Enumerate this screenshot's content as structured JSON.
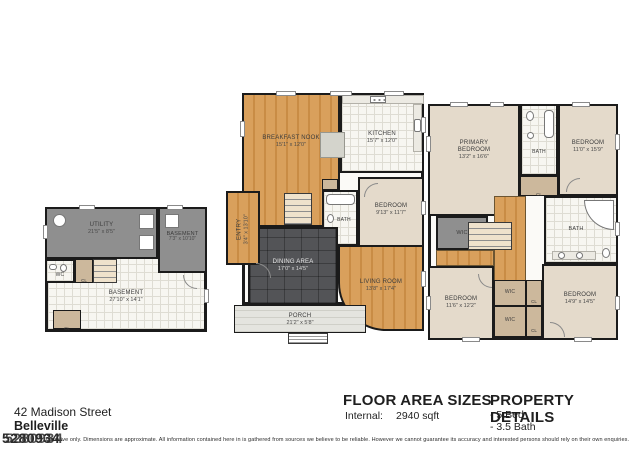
{
  "footer": {
    "address_line1": "42 Madison Street",
    "address_line2": "Belleville",
    "floor_area": {
      "title": "FLOOR AREA SIZES",
      "label": "Internal:",
      "value": "2940 sqft"
    },
    "property_details": {
      "title": "PROPERTY DETAILS",
      "items": [
        "- 5 Bed",
        "- 3.5 Bath"
      ]
    },
    "listing_id": "5280934",
    "disclaimer": "Indicative only. Dimensions are approximate. All information contained here in is gathered from sources we believe to be reliable. However we cannot guarantee its accuracy and interested persons should rely on their own enquiries."
  },
  "labels": {
    "cl": "CL",
    "wic": "WIC",
    "wc": "WC",
    "bath": "BATH"
  },
  "plans": {
    "basement": {
      "rooms": {
        "utility": {
          "name": "UTILITY",
          "dims": "21'5\" x 8'5\""
        },
        "basement_upper": {
          "name": "BASEMENT",
          "dims": "7'3\" x 10'10\""
        },
        "basement_main": {
          "name": "BASEMENT",
          "dims": "27'10\" x 14'1\""
        }
      }
    },
    "first_floor": {
      "rooms": {
        "breakfast_nook": {
          "name": "BREAKFAST NOOK",
          "dims": "15'1\" x 12'0\""
        },
        "kitchen": {
          "name": "KITCHEN",
          "dims": "15'7\" x 12'0\""
        },
        "bedroom": {
          "name": "BEDROOM",
          "dims": "9'13\" x 11'7\""
        },
        "dining": {
          "name": "DINING AREA",
          "dims": "17'0\" x 14'5\""
        },
        "living": {
          "name": "LIVING ROOM",
          "dims": "13'8\" x 17'4\""
        },
        "entry": {
          "name": "ENTRY",
          "dims": "3'4\" x 13'10\""
        },
        "porch": {
          "name": "PORCH",
          "dims": "21'2\" x 5'8\""
        }
      }
    },
    "second_floor": {
      "rooms": {
        "primary_bedroom": {
          "name": "PRIMARY BEDROOM",
          "dims": "13'2\" x 16'6\""
        },
        "bedroom_tr": {
          "name": "BEDROOM",
          "dims": "11'0\" x 15'9\""
        },
        "bedroom_bl": {
          "name": "BEDROOM",
          "dims": "11'6\" x 12'2\""
        },
        "bedroom_br": {
          "name": "BEDROOM",
          "dims": "14'9\" x 14'5\""
        }
      }
    }
  },
  "colors": {
    "wall": "#1b1b1b",
    "wood_floor": "#d9a05c",
    "slate_floor": "#535457",
    "bedroom_beige": "#e4dacb",
    "utility_gray": "#8f8f8f",
    "closet_tan": "#ccb89c",
    "tile_white": "#f7f6f1",
    "porch_gray": "#e4e4df"
  }
}
